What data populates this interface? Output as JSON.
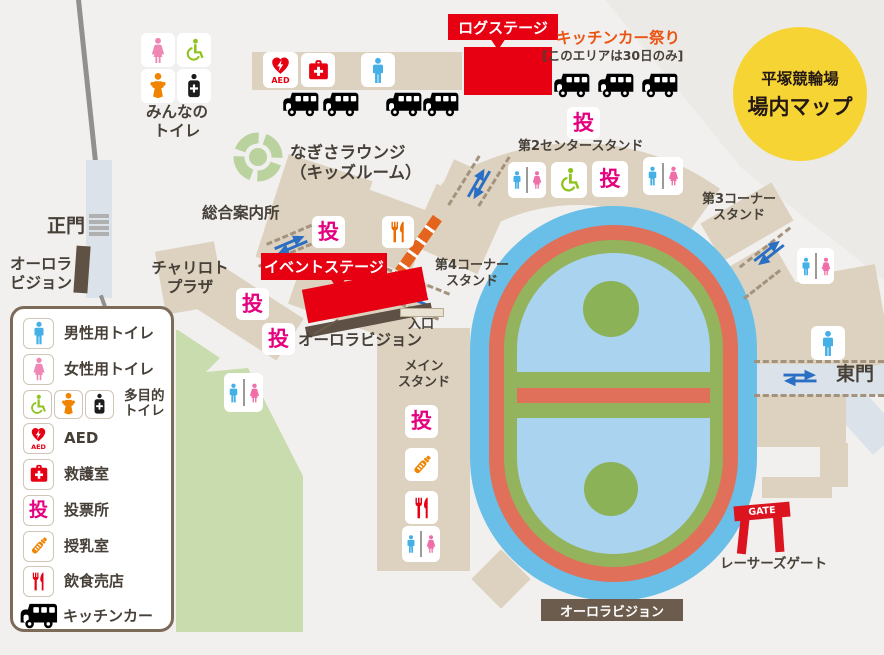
{
  "badge": {
    "venue": "平塚競輪場",
    "title": "場内マップ"
  },
  "glyphs": {
    "vote": "投",
    "aed": "AED",
    "gate": "GATE"
  },
  "labels": {
    "minna_toilet": "みんなの\nトイレ",
    "log_stage": "ログステージ",
    "kitchen_fest": "キッチンカー祭り",
    "kitchen_note": "[このエリアは30日のみ]",
    "nagisa": "なぎさラウンジ\n（キッズルーム）",
    "info_center": "総合案内所",
    "main_gate": "正門",
    "aurora_west": "オーロラ\nビジョン",
    "chariloto": "チャリロト\nプラザ",
    "event_stage": "イベントステージ",
    "aurora_stage": "オーロラビジョン",
    "stand2": "第2センタースタンド",
    "stand3": "第3コーナー\nスタンド",
    "stand4": "第4コーナー\nスタンド",
    "main_stand": "メイン\nスタンド",
    "entrance": "入口",
    "east_gate": "東門",
    "racers_gate": "レーサーズゲート",
    "aurora_south": "オーロラビジョン"
  },
  "legend": {
    "items": [
      {
        "icon": "toilet-male",
        "label": "男性用トイレ"
      },
      {
        "icon": "toilet-female",
        "label": "女性用トイレ"
      },
      {
        "icon": "multi-toilet",
        "label": "多目的\nトイレ"
      },
      {
        "icon": "aed",
        "label": "AED"
      },
      {
        "icon": "first-aid-room",
        "label": "救護室"
      },
      {
        "icon": "polling-place",
        "label": "投票所"
      },
      {
        "icon": "nursing-room",
        "label": "授乳室"
      },
      {
        "icon": "food-stand",
        "label": "飲食売店"
      },
      {
        "icon": "kitchen-car",
        "label": "キッチンカー"
      }
    ]
  },
  "colors": {
    "stage_red": "#e60012",
    "vote_pink": "#e4007f",
    "kitchen_orange": "#ea5514",
    "badge_yellow": "#f6d434",
    "track_blue": "#69bfe8",
    "infield_blue": "#a9d3ee",
    "track_band_red": "#e0705a",
    "track_band_green": "#93b35d",
    "stand_tan": "#dcd2bf",
    "park_green": "#c8dcae"
  }
}
